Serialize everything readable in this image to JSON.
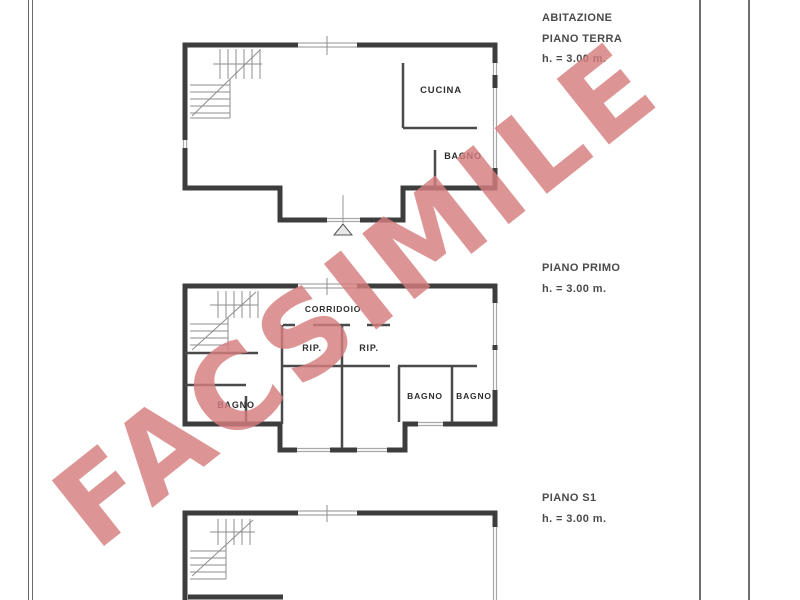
{
  "watermark": {
    "text": "FACSIMILE",
    "color": "#d67c7e"
  },
  "floors": {
    "terra": {
      "title": "ABITAZIONE",
      "subtitle": "PIANO TERRA",
      "height": "h. = 3.00 m.",
      "rooms": {
        "cucina": "CUCINA",
        "bagno": "BAGNO"
      }
    },
    "primo": {
      "title": "PIANO PRIMO",
      "height": "h. = 3.00 m.",
      "rooms": {
        "corridoio": "CORRIDOIO",
        "rip_left": "RIP.",
        "rip_right": "RIP.",
        "bagno_left": "BAGNO",
        "bagno_center": "BAGNO",
        "bagno_right": "BAGNO"
      }
    },
    "s1": {
      "title": "PIANO S1",
      "height": "h. = 3.00 m."
    }
  }
}
